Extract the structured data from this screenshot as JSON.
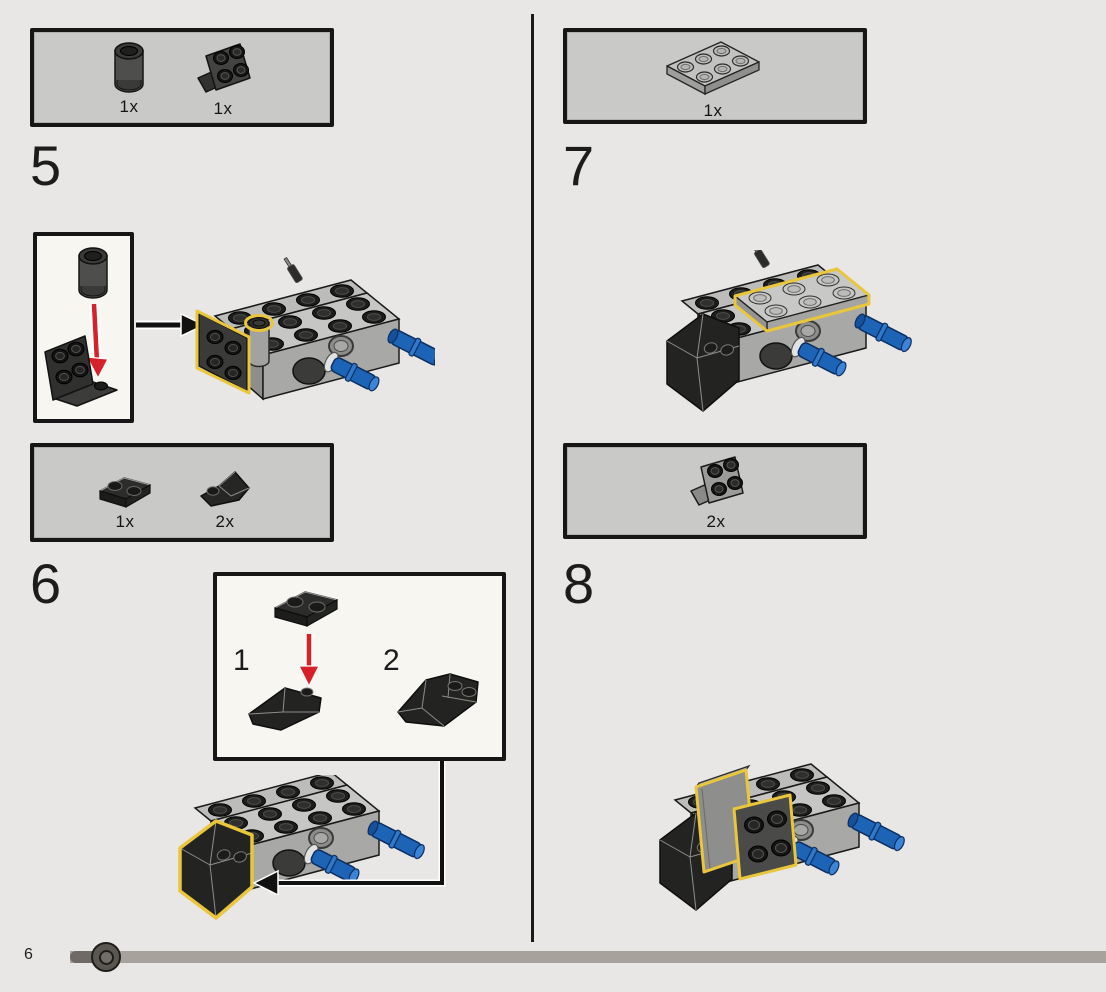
{
  "page": {
    "number": "6"
  },
  "steps": {
    "step5": {
      "label": "5",
      "parts": [
        {
          "name": "round-brick-1x1-dark-gray",
          "count": "1x"
        },
        {
          "name": "bracket-1x2-2x2-dark-gray",
          "count": "1x"
        }
      ]
    },
    "step6": {
      "label": "6",
      "parts": [
        {
          "name": "plate-1x2-black",
          "count": "1x"
        },
        {
          "name": "inverted-slope-1x2-black",
          "count": "2x"
        }
      ],
      "inset": {
        "substep1_label": "1",
        "substep2_label": "2"
      }
    },
    "step7": {
      "label": "7",
      "parts": [
        {
          "name": "plate-2x3-light-gray",
          "count": "1x"
        }
      ]
    },
    "step8": {
      "label": "8",
      "parts": [
        {
          "name": "bracket-1x2-2x2-gray",
          "count": "2x"
        }
      ]
    }
  },
  "colors": {
    "highlight_yellow": "#e9c63b",
    "pin_blue": "#1e64b6",
    "arrow_red": "#d52127",
    "box_fill": "#c9c9c7",
    "inset_fill": "#f8f6f1",
    "background": "#e8e7e5",
    "progress_track": "#a7a29b",
    "progress_fill": "#6f6b64"
  }
}
